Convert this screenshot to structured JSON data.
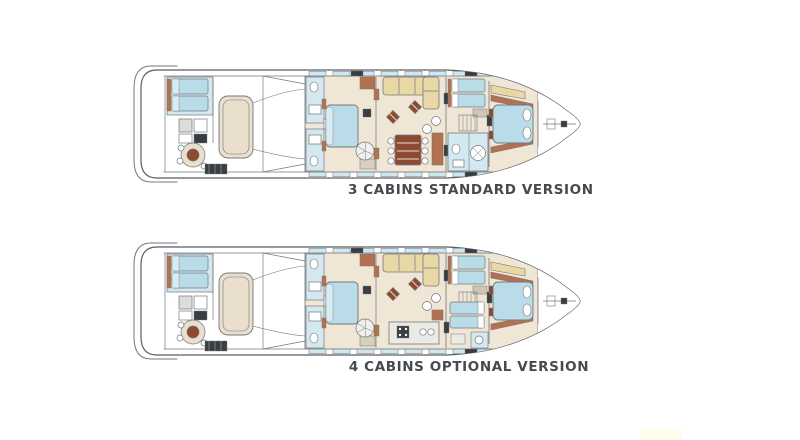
{
  "diagram": {
    "type": "yacht-deck-plans",
    "plans": [
      {
        "id": "standard",
        "cabins": "3",
        "label": "3 CABINS STANDARD VERSION",
        "variant": "standard"
      },
      {
        "id": "optional",
        "cabins": "4",
        "label": "4 CABINS OPTIONAL VERSION",
        "variant": "optional"
      }
    ],
    "palette": {
      "outline": "#73777c",
      "outline_dark": "#5a5e63",
      "floor_cream": "#f0e6d5",
      "floor_tan": "#e9dfcc",
      "bed_blue": "#badbe8",
      "bed_blue_light": "#d9ecf4",
      "bath_blue": "#d3e8f0",
      "window_blue": "#cfe7f0",
      "sofa_tan": "#e8d8a6",
      "wood_terracotta": "#b3714f",
      "wood_dark": "#8d4a33",
      "dark_detail": "#3b3e41",
      "label_color": "#47494c",
      "watermark": "#fffcee",
      "background": "#ffffff"
    }
  }
}
